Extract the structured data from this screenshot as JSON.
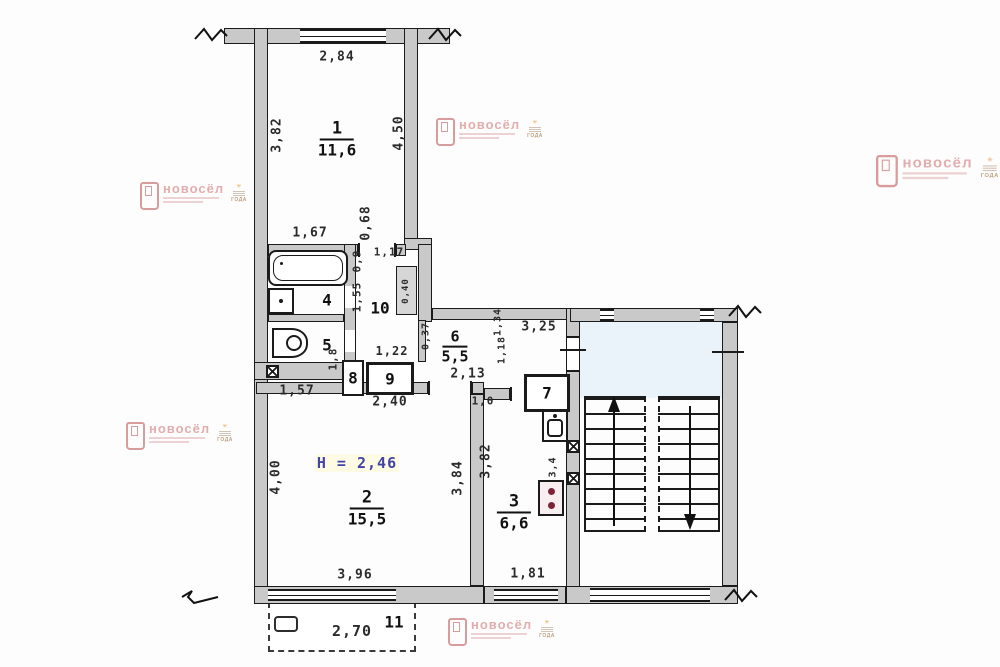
{
  "watermark": {
    "brand": "новосёл",
    "badge_year": "ГОДА",
    "accent_color": "#dc9a9a",
    "badge_color": "#e09a3e",
    "positions": [
      {
        "x": 436,
        "y": 118,
        "sc": 1
      },
      {
        "x": 876,
        "y": 155,
        "sc": 1.15
      },
      {
        "x": 140,
        "y": 182,
        "sc": 1
      },
      {
        "x": 126,
        "y": 422,
        "sc": 1
      },
      {
        "x": 448,
        "y": 618,
        "sc": 1
      }
    ]
  },
  "plan": {
    "height_note": "H = 2,46",
    "height_note_pos": {
      "x": 357,
      "y": 463
    },
    "room_areas": [
      {
        "number": "1",
        "area": "11,6",
        "x": 337,
        "y": 139,
        "small": false
      },
      {
        "number": "2",
        "area": "15,5",
        "x": 367,
        "y": 508,
        "small": false
      },
      {
        "number": "3",
        "area": "6,6",
        "x": 514,
        "y": 512,
        "small": false
      },
      {
        "number": "6",
        "area": "5,5",
        "x": 455,
        "y": 346,
        "small": true
      }
    ],
    "room_numbers": [
      {
        "t": "4",
        "x": 327,
        "y": 300
      },
      {
        "t": "5",
        "x": 327,
        "y": 345
      },
      {
        "t": "7",
        "x": 547,
        "y": 393
      },
      {
        "t": "8",
        "x": 353,
        "y": 378
      },
      {
        "t": "9",
        "x": 390,
        "y": 379
      },
      {
        "t": "10",
        "x": 380,
        "y": 308
      },
      {
        "t": "11",
        "x": 394,
        "y": 622
      }
    ],
    "dimensions": [
      {
        "t": "2,84",
        "x": 337,
        "y": 57
      },
      {
        "t": "3,82",
        "x": 277,
        "y": 135,
        "r": 1
      },
      {
        "t": "4,50",
        "x": 399,
        "y": 133,
        "r": 1
      },
      {
        "t": "1,67",
        "x": 310,
        "y": 233
      },
      {
        "t": "0,68",
        "x": 366,
        "y": 223,
        "r": 1
      },
      {
        "t": "1,17",
        "x": 389,
        "y": 252,
        "s": 11
      },
      {
        "t": "0,9",
        "x": 357,
        "y": 261,
        "r": 1,
        "s": 11
      },
      {
        "t": "1,55",
        "x": 357,
        "y": 297,
        "r": 1,
        "s": 11
      },
      {
        "t": "0,40",
        "x": 406,
        "y": 291,
        "r": 1,
        "s": 9
      },
      {
        "t": "1,8",
        "x": 333,
        "y": 359,
        "r": 1,
        "s": 11
      },
      {
        "t": "1,57",
        "x": 297,
        "y": 391
      },
      {
        "t": "2,40",
        "x": 390,
        "y": 402
      },
      {
        "t": "1,22",
        "x": 392,
        "y": 351,
        "s": 12
      },
      {
        "t": "0,37",
        "x": 426,
        "y": 336,
        "r": 1,
        "s": 10
      },
      {
        "t": "2,13",
        "x": 468,
        "y": 374
      },
      {
        "t": "1,18",
        "x": 502,
        "y": 350,
        "r": 1,
        "s": 10
      },
      {
        "t": "1,34",
        "x": 498,
        "y": 322,
        "r": 1,
        "s": 10
      },
      {
        "t": "3,25",
        "x": 539,
        "y": 327
      },
      {
        "t": "1,0",
        "x": 483,
        "y": 401,
        "s": 11
      },
      {
        "t": "3,82",
        "x": 486,
        "y": 461,
        "r": 1
      },
      {
        "t": "3,4",
        "x": 553,
        "y": 467,
        "r": 1,
        "s": 10
      },
      {
        "t": "4,00",
        "x": 276,
        "y": 477,
        "r": 1
      },
      {
        "t": "3,84",
        "x": 458,
        "y": 478,
        "r": 1
      },
      {
        "t": "3,96",
        "x": 355,
        "y": 575
      },
      {
        "t": "1,81",
        "x": 528,
        "y": 574
      },
      {
        "t": "2,70",
        "x": 352,
        "y": 631,
        "s": 15
      }
    ]
  }
}
